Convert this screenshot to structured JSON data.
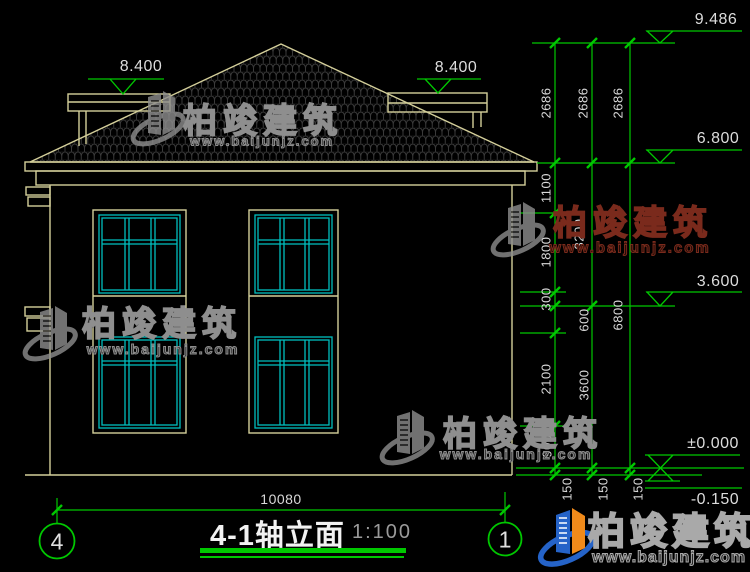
{
  "title": {
    "name": "4-1轴立面",
    "scale": "1:100"
  },
  "axis": {
    "left": "4",
    "right": "1"
  },
  "levels": {
    "ridge": "9.486",
    "eave": "6.800",
    "floor2": "3.600",
    "zero": "±0.000",
    "minus": "-0.150",
    "parapet_left": "8.400",
    "parapet_right": "8.400"
  },
  "dims": {
    "width": "10080",
    "roof": [
      "2686",
      "2686",
      "2686"
    ],
    "inner": [
      "1100",
      "1800",
      "300",
      "600",
      "2100",
      "900"
    ],
    "mid": [
      "3200",
      "3600"
    ],
    "outer": [
      "6800"
    ],
    "base": [
      "150",
      "150",
      "150"
    ]
  },
  "watermark": {
    "brand": "柏竣建筑",
    "url": "www.baijunjz.com"
  },
  "logo": {
    "brand": "柏竣建筑",
    "url": "www.baijunjz.com"
  },
  "colors": {
    "background": "#000000",
    "building_line": "#d4cf9a",
    "window_frame": "#00bfbf",
    "dimension_green": "#00c800",
    "dim_text": "#d9d9d9",
    "watermark_gray": "#8e8e8e",
    "watermark_red": "#7a2a1c",
    "logo_blue": "#2563c8",
    "logo_orange": "#f08a1a"
  }
}
